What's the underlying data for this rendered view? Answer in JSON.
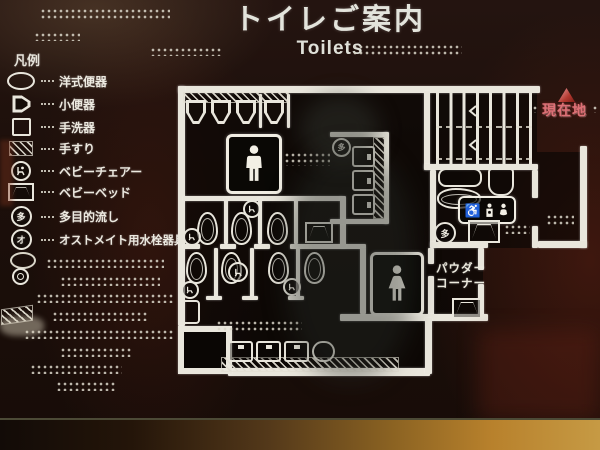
{
  "sign": {
    "title_jp": "トイレご案内",
    "title_en": "Toilets",
    "colors": {
      "sign_background": "#1c0f0a",
      "engraved_line": "#e9e6dc",
      "current_location_red": "#dd7076",
      "frame_wood": "#b8812c"
    },
    "legend": {
      "heading": "凡例",
      "items": [
        {
          "icon": "western-toilet-icon",
          "label": "洋式便器"
        },
        {
          "icon": "urinal-icon",
          "label": "小便器"
        },
        {
          "icon": "washbasin-icon",
          "label": "手洗器"
        },
        {
          "icon": "handrail-icon",
          "label": "手すり"
        },
        {
          "icon": "baby-chair-icon",
          "label": "ベビーチェアー"
        },
        {
          "icon": "baby-bed-icon",
          "label": "ベビーベッド"
        },
        {
          "icon": "multipurpose-sink-icon",
          "label": "多目的流し",
          "badge": "多"
        },
        {
          "icon": "ostomate-icon",
          "label": "オストメイト用水栓器具",
          "badge": "オ"
        }
      ]
    },
    "map": {
      "current_location_label": "現在地",
      "powder_corner_line1": "パウダー",
      "powder_corner_line2": "コーナー",
      "accessible_sign_symbol": "♿",
      "multipurpose_sink_badge": "多"
    }
  }
}
